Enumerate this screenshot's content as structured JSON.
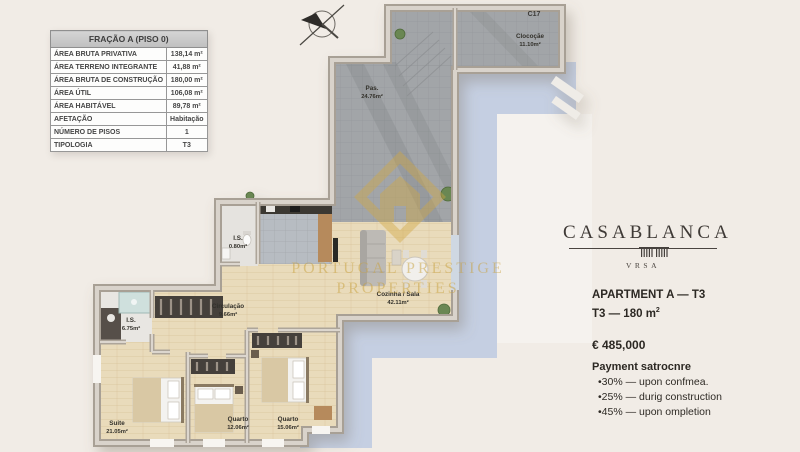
{
  "info_table": {
    "header": "FRAÇÃO A (PISO 0)",
    "rows": [
      {
        "label": "ÁREA BRUTA PRIVATIVA",
        "value": "138,14 m²"
      },
      {
        "label": "ÁREA TERRENO INTEGRANTE",
        "value": "41,88 m²"
      },
      {
        "label": "ÁREA BRUTA DE CONSTRUÇÃO",
        "value": "180,00 m²"
      },
      {
        "label": "ÁREA ÚTIL",
        "value": "106,08 m²"
      },
      {
        "label": "ÁREA HABITÁVEL",
        "value": "89,78 m²"
      },
      {
        "label": "AFETAÇÃO",
        "value": "Habitação"
      },
      {
        "label": "NÚMERO DE PISOS",
        "value": "1"
      },
      {
        "label": "TIPOLOGIA",
        "value": "T3"
      }
    ]
  },
  "floor_plan": {
    "unit_code": "C17",
    "rooms": [
      {
        "name": "Clocoçãe",
        "area": "11.10m²"
      },
      {
        "name": "Pas.",
        "area": "24.76m²"
      },
      {
        "name": "I.S.",
        "area": "0.80m²"
      },
      {
        "name": "Cozinha / Sala",
        "area": "42.11m²"
      },
      {
        "name": "Circulação",
        "area": "9.66m²"
      },
      {
        "name": "I.S.",
        "area": "6.75m²"
      },
      {
        "name": "Suite",
        "area": "21.05m²"
      },
      {
        "name": "Quarto",
        "area": "12.06m²"
      },
      {
        "name": "Quarto",
        "area": "15.06m²"
      }
    ],
    "watermark": {
      "line1": "PORTUGAL PRESTIGE",
      "line2": "PROPERTIES"
    }
  },
  "brand": {
    "name": "CASABLANCA",
    "sub": "VRSA"
  },
  "listing": {
    "title_line1": "APARTMENT A — T3",
    "title_line2": "T3 — 180 m",
    "title_line2_sup": "2",
    "price": "€ 485,000",
    "payment_title": "Payment satrocnre",
    "payment_items": [
      "•30% — upon confmea.",
      "•25% — durig construction",
      "•45% — upon ompletion"
    ]
  },
  "colors": {
    "background": "#f1ece6",
    "wall": "#a8a095",
    "wood_floor": "#e9dbbb",
    "tile": "#a2a5a8",
    "blue_slab": "#c5cfe2",
    "watermark_gold": "#cfa544",
    "brand_text": "#3f3a36"
  }
}
